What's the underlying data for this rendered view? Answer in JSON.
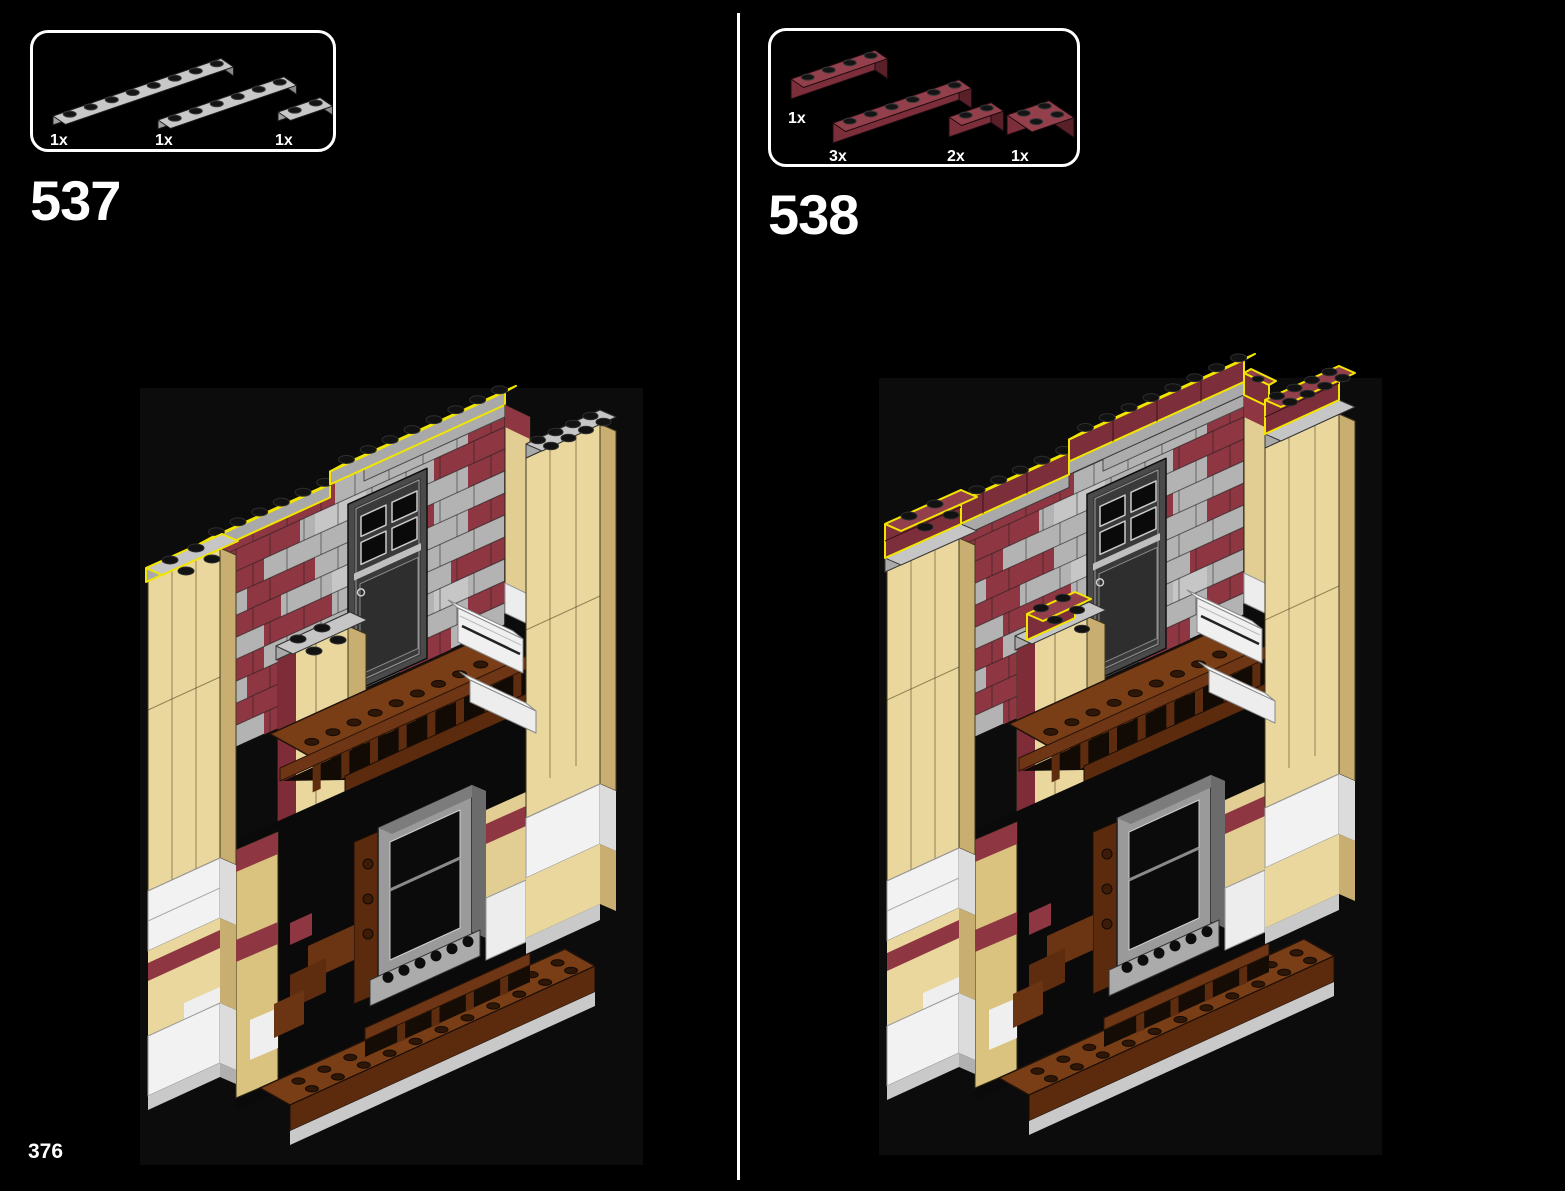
{
  "page": {
    "number": "376"
  },
  "steps": [
    {
      "number": "537",
      "highlight": "new-light-gray-plates",
      "parts": [
        {
          "count": "1x",
          "part": "plate-1x8-light-gray"
        },
        {
          "count": "1x",
          "part": "plate-1x6-light-gray"
        },
        {
          "count": "1x",
          "part": "plate-1x2-light-gray"
        }
      ]
    },
    {
      "number": "538",
      "highlight": "new-dark-red-bricks",
      "parts": [
        {
          "count": "1x",
          "part": "brick-1x4-dark-red"
        },
        {
          "count": "3x",
          "part": "brick-1x6-dark-red"
        },
        {
          "count": "2x",
          "part": "brick-1x2-dark-red"
        },
        {
          "count": "1x",
          "part": "brick-2x2-dark-red"
        }
      ]
    }
  ],
  "colors": {
    "background": "#000000",
    "highlight_yellow": "#F2E600",
    "wall_gray": "#B3B3B3",
    "wall_red": "#8E3642",
    "dark_red": "#7C2F3A",
    "dark_red_top": "#93404C",
    "dark_red_side": "#59202A",
    "plate_gray": "#A9A9A9",
    "plate_gray_top": "#C6C6C6",
    "plate_gray_side": "#848484",
    "tan": "#E9D79E",
    "tan_side": "#C9AE72",
    "white_brick": "#F2F2F2",
    "brown_floor": "#7A3E16",
    "brown_front": "#5C2B0E",
    "brown_rail": "#6E3614",
    "stud_black": "#121212",
    "base_gray": "#C9C9C9"
  }
}
